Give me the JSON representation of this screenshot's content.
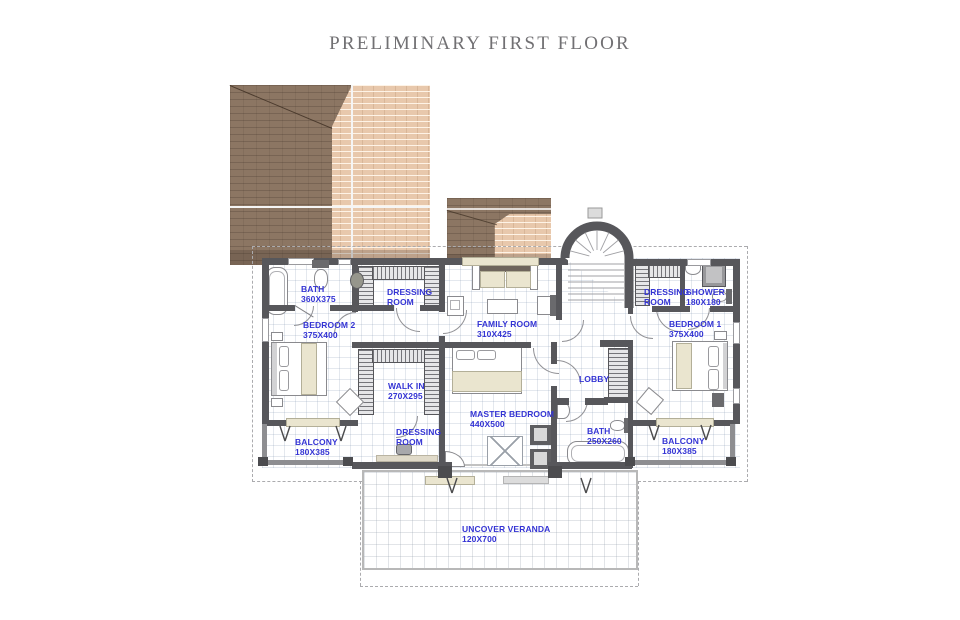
{
  "title": "PRELIMINARY FIRST FLOOR",
  "rooms": {
    "bath2": {
      "name": "BATH",
      "dims": "360X375"
    },
    "dressing_tl": {
      "name": "DRESSING ROOM",
      "dims": ""
    },
    "bedroom2": {
      "name": "BEDROOM 2",
      "dims": "375X400"
    },
    "family": {
      "name": "FAMILY ROOM",
      "dims": "310X425"
    },
    "dressing_tr": {
      "name": "DRESSING ROOM",
      "dims": ""
    },
    "shower": {
      "name": "SHOWER",
      "dims": "180X180"
    },
    "bedroom1": {
      "name": "BEDROOM 1",
      "dims": "375X400"
    },
    "walkin": {
      "name": "WALK IN",
      "dims": "270X295"
    },
    "lobby": {
      "name": "LOBBY",
      "dims": ""
    },
    "master": {
      "name": "MASTER BEDROOM",
      "dims": "440X500"
    },
    "bath1": {
      "name": "BATH",
      "dims": "250X260"
    },
    "dressing_b": {
      "name": "DRESSING ROOM",
      "dims": ""
    },
    "balcony_l": {
      "name": "BALCONY",
      "dims": "180X385"
    },
    "balcony_r": {
      "name": "BALCONY",
      "dims": "180X385"
    },
    "veranda": {
      "name": "UNCOVER VERANDA",
      "dims": "120X700"
    }
  },
  "colors": {
    "label_blue": "#3434d4",
    "wall_gray": "#57575b",
    "roof_dark_brown": "#8c7663",
    "roof_light_tan": "#e8c8ac",
    "title_gray": "#717073"
  }
}
